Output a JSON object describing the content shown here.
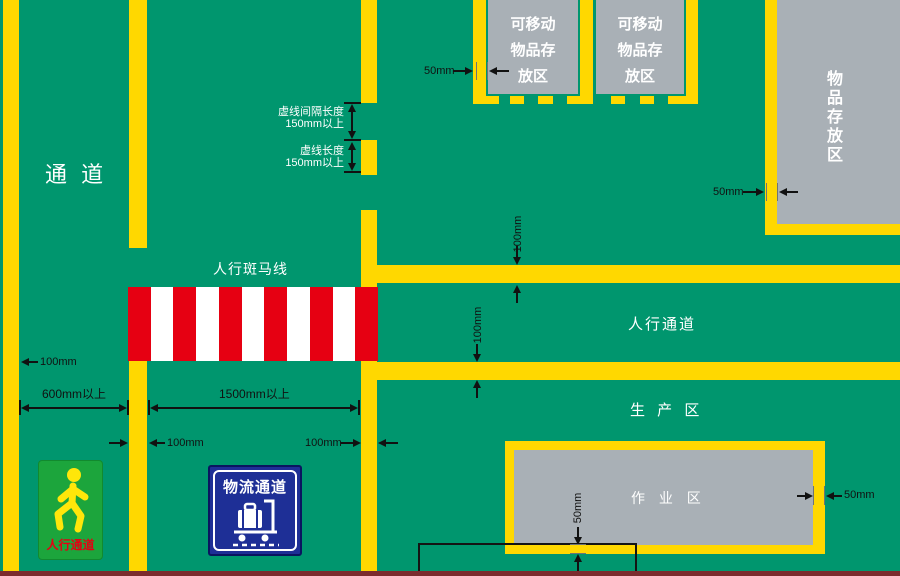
{
  "palette": {
    "floor_green": "#00966E",
    "line_yellow": "#FFD800",
    "zebra_red": "#E60012",
    "zebra_white": "#FFFFFF",
    "storage_gray": "#A9B0B6",
    "bottom_strip_maroon": "#7C2B2E",
    "pedestrian_sign_green": "#1CA53C",
    "pedestrian_sign_figure_yellow": "#FFE60A",
    "logistics_sign_blue": "#1E2F96",
    "annotation_black": "#111111",
    "label_white": "#FFFFFF",
    "sign_text_red": "#E60012"
  },
  "labels": {
    "aisle": "通 道",
    "zebra_crossing": "人行斑马线",
    "pedestrian_aisle": "人行通道",
    "production_area": "生 产 区",
    "work_area": "作 业 区",
    "storage_area_vertical": "物品存放区",
    "movable_storage_lines": [
      "可移动",
      "物品存",
      "放区"
    ]
  },
  "annotations": {
    "dash_gap_line1": "虚线间隔长度",
    "dash_gap_line2": "150mm以上",
    "dash_length_line1": "虚线长度",
    "dash_length_line2": "150mm以上",
    "dim_50": "50mm",
    "dim_100": "100mm",
    "dim_600": "600mm以上",
    "dim_1500": "1500mm以上"
  },
  "signs": {
    "pedestrian": "人行通道",
    "logistics": "物流通道"
  }
}
